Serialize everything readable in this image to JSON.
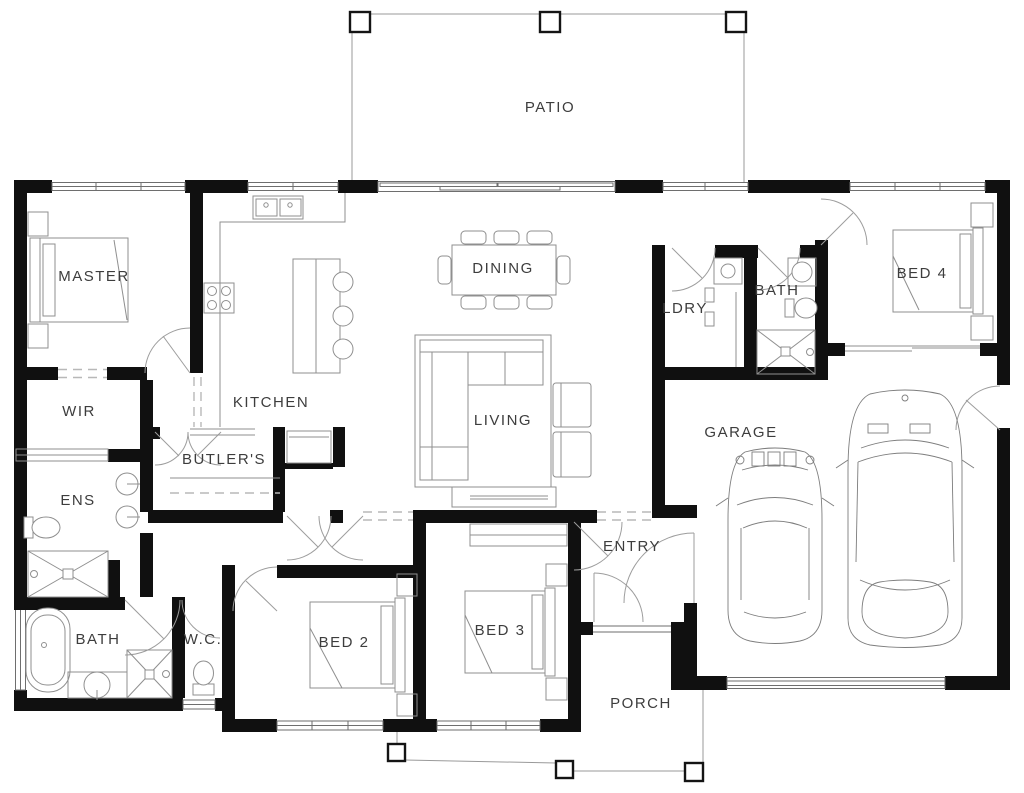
{
  "plan": {
    "type": "residential-floor-plan",
    "colors": {
      "wall": "#101010",
      "furniture_line": "#8f8f8f",
      "door_line": "#9d9d9d",
      "dashed_opening": "#b8b8b8",
      "label": "#3d3d3d",
      "background": "#ffffff"
    },
    "rooms": [
      {
        "id": "patio",
        "label": "PATIO"
      },
      {
        "id": "master",
        "label": "MASTER"
      },
      {
        "id": "kitchen",
        "label": "KITCHEN"
      },
      {
        "id": "dining",
        "label": "DINING"
      },
      {
        "id": "ldry",
        "label": "LDRY"
      },
      {
        "id": "bath-upper",
        "label": "BATH"
      },
      {
        "id": "bed4",
        "label": "BED 4"
      },
      {
        "id": "wir",
        "label": "WIR"
      },
      {
        "id": "butlers",
        "label": "BUTLER'S"
      },
      {
        "id": "living",
        "label": "LIVING"
      },
      {
        "id": "ens",
        "label": "ENS"
      },
      {
        "id": "garage",
        "label": "GARAGE"
      },
      {
        "id": "entry",
        "label": "ENTRY"
      },
      {
        "id": "bath-lower",
        "label": "BATH"
      },
      {
        "id": "wc",
        "label": "W.C."
      },
      {
        "id": "bed2",
        "label": "BED 2"
      },
      {
        "id": "bed3",
        "label": "BED 3"
      },
      {
        "id": "porch",
        "label": "PORCH"
      }
    ]
  }
}
